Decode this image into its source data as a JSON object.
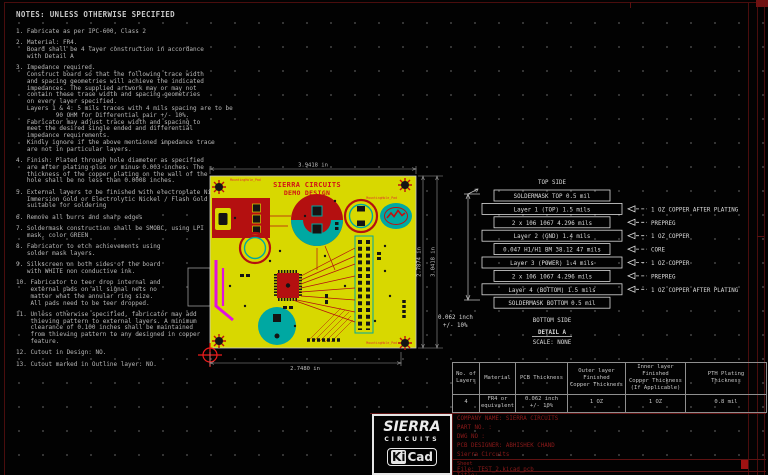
{
  "sheet": {
    "colors": {
      "frame_red": "#4a0d0d",
      "board_yellow": "#d8d800",
      "copper_red": "#b41010",
      "teal": "#00a8a2",
      "magenta": "#e012e0",
      "silkscreen_red": "#d01414",
      "notes_grey": "#b8b8b8",
      "stackup_white": "#dcdcdc",
      "title_block_red": "#8c1a1a"
    }
  },
  "notes": {
    "title": "NOTES: UNLESS OTHERWISE SPECIFIED",
    "items": [
      {
        "num": "1.",
        "lines": [
          "Fabricate as per IPC-600, Class 2"
        ]
      },
      {
        "num": "2.",
        "lines": [
          "Material: FR4.",
          "Board shall be 4 layer construction in accordance",
          "with Detail A"
        ]
      },
      {
        "num": "3.",
        "lines": [
          "Impedance required.",
          "Construct board so that the following trace width",
          "and spacing geometries will achieve the indicated",
          "impedances. The supplied artwork may or may not",
          "contain these trace width and spacing geometries",
          "on every layer specified.",
          "Layers 1 & 4: 5 mils traces with 4 mils spacing are to be",
          "        90 OHM for Differential pair +/- 10%.",
          "Fabricator may adjust trace width and spacing to",
          "meet the desired single ended and differential",
          "impedance requirements.",
          "Kindly ignore if the above mentioned impedance trace",
          "are not in particular layers."
        ]
      },
      {
        "num": "4.",
        "lines": [
          "Finish: Plated through hole diameter as specified",
          "are after plating plus or minus 0.003 inches. The",
          "thickness of the copper plating on the wall of the",
          "hole shall be no less than 0.0008 inches."
        ]
      },
      {
        "num": "5.",
        "lines": [
          "External layers to be finished with electroplate Nickel/",
          "Immersion Gold or Electrolytic Nickel / Flash Gold",
          "suitable for soldering"
        ]
      },
      {
        "num": "6.",
        "lines": [
          "Remove all burrs and sharp edges"
        ]
      },
      {
        "num": "7.",
        "lines": [
          "Soldermask construction shall be SMOBC, using LPI",
          "mask, color GREEN"
        ]
      },
      {
        "num": "8.",
        "lines": [
          "Fabricator to etch achievements using",
          "solder mask layers."
        ]
      },
      {
        "num": "9.",
        "lines": [
          "Silkscreen on both sides of the board",
          "with WHITE non conductive ink."
        ]
      },
      {
        "num": "10.",
        "lines": [
          "Fabricator to teer drop internal and",
          "external pads on all signal nets no",
          "matter what the annular ring size.",
          "All pads need to be teer dropped."
        ]
      },
      {
        "num": "11.",
        "lines": [
          "Unless otherwise specified, fabricator may add",
          "thieving pattern to external layers. A minimum",
          "clearance of 0.100 inches shall be maintained",
          "from thieving pattern to any designed in copper",
          "feature."
        ]
      },
      {
        "num": "12.",
        "lines": [
          "Cutout in Design: NO."
        ]
      },
      {
        "num": "13.",
        "lines": [
          "Cutout marked in Outline layer: NO."
        ]
      }
    ]
  },
  "pcb": {
    "silkscreen_title_1": "SIERRA CIRCUITS",
    "silkscreen_title_2": "DEMO DESIGN",
    "mounting_hole_label": "MountingHole_Pad",
    "dim_top": "3.9418 in",
    "dim_bottom": "2.7480 in",
    "dim_right_inner": "2.7874 in",
    "dim_right_outer": "3.0418 in"
  },
  "stackup": {
    "top_label": "TOP SIDE",
    "bottom_label": "BOTTOM SIDE",
    "detail_label": "DETAIL A",
    "scale_label": "SCALE: NONE",
    "thickness_note_1": "0.062 inch",
    "thickness_note_2": "+/- 10%",
    "rows": [
      {
        "text": "SOLDERMASK TOP   0.5 mil",
        "w": "narrow",
        "arrow": ""
      },
      {
        "text": "Layer 1 (TOP)  1.5 mils",
        "w": "wide",
        "arrow": "1 OZ COPPER AFTER PLATING"
      },
      {
        "text": "2 x 106 1067    4.296 mils",
        "w": "narrow",
        "arrow": "PREPREG"
      },
      {
        "text": "Layer 2 (GND)  1.4 mils",
        "w": "wide",
        "arrow": "1 OZ COPPER"
      },
      {
        "text": "0.047 H1/H1 BM 38.12  47 mils",
        "w": "narrow",
        "arrow": "CORE"
      },
      {
        "text": "Layer 3 (POWER) 1.4 mils",
        "w": "wide",
        "arrow": "1 OZ COPPER"
      },
      {
        "text": "2 x 106 1067    4.296 mils",
        "w": "narrow",
        "arrow": "PREPREG"
      },
      {
        "text": "Layer 4 (BOTTOM) 1.5 mils",
        "w": "wide",
        "arrow": "1 OZ COPPER AFTER PLATING"
      },
      {
        "text": "SOLDERMASK BOTTOM  0.5 mil",
        "w": "narrow",
        "arrow": ""
      }
    ]
  },
  "spec_table": {
    "headers": [
      "No. of\nLayers",
      "Material",
      "PCB Thickness",
      "Outer layer\nFinished\nCopper Thickness",
      "Inner layer Finished\nCopper Thickness\n(If Applicable)",
      "PTH Plating\nThickness"
    ],
    "row": [
      "4",
      "FR4 or\nequivalent",
      "0.062 inch\n+/- 10%",
      "1 OZ",
      "1 OZ",
      "0.8 mil"
    ],
    "col_widths": [
      27,
      36,
      52,
      58,
      60,
      81
    ]
  },
  "logos": {
    "sierra_line1": "SIERRA",
    "sierra_line2": "CIRCUITS",
    "kicad_ki": "Ki",
    "kicad_cad": "Cad"
  },
  "title_block": {
    "company": "COMPANY NAME: SIERRA CIRCUITS",
    "part_no": "PART NO. :",
    "dwg_no": "DWG NO :",
    "designer": "PCB DESIGNER: ABHISHEK CHAND",
    "firm": "Sierra Circuits",
    "sheet_label": "Sheet",
    "file_label": "File: TEST_2.kicad_pcb",
    "title_label": "Title:"
  }
}
